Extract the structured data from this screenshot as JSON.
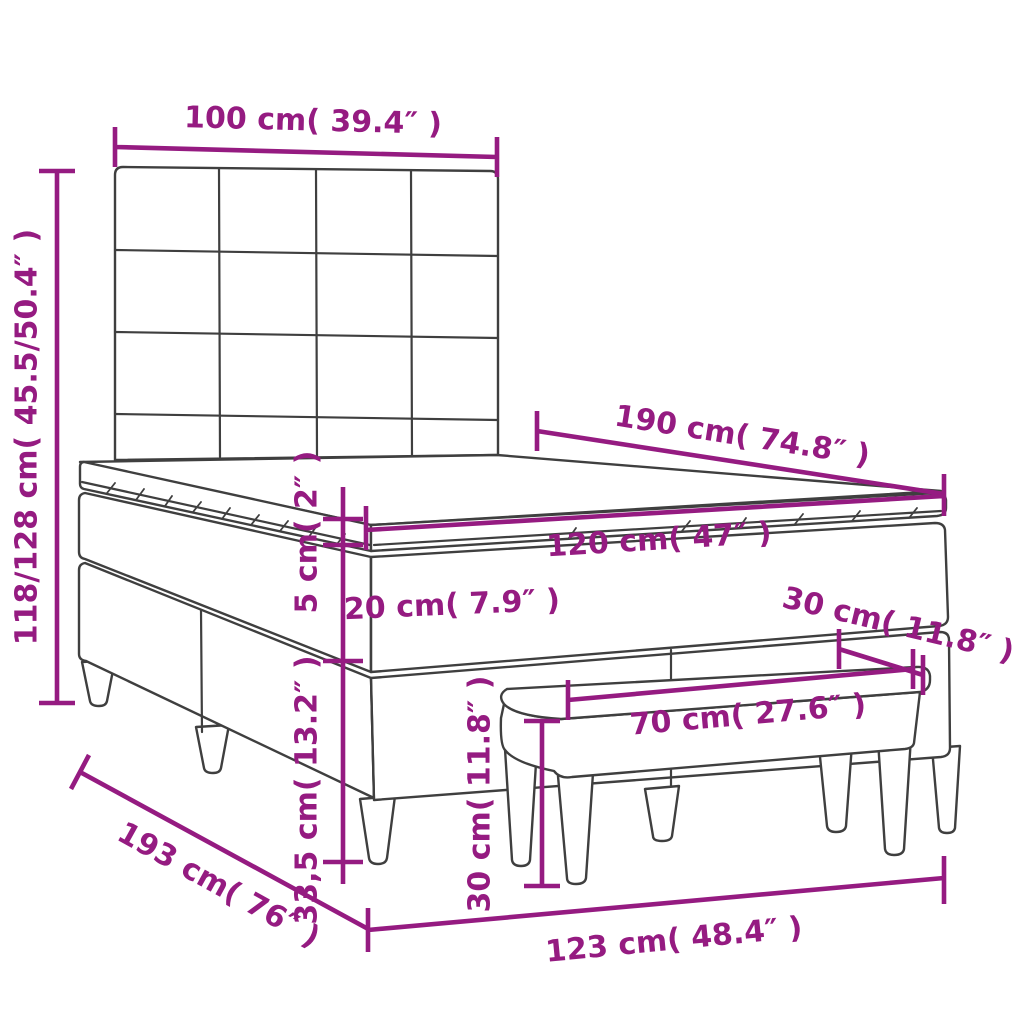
{
  "diagram": {
    "title": "bed with headboard and bench dimension diagram",
    "style": {
      "accent_color": "#951b81",
      "line_art_color": "#3f3f3f",
      "background_color": "#ffffff"
    },
    "parts": {
      "headboard": "tufted headboard (4x4 grid)",
      "topper": "mattress topper",
      "mattress": "mattress",
      "base": "box spring base",
      "bench": "bench with tapered legs"
    },
    "dimensions": [
      {
        "id": "headboard-width",
        "label": "100 cm( 39.4″ )",
        "measures": "headboard width"
      },
      {
        "id": "total-height",
        "label": "118/128 cm( 45.5/50.4″ )",
        "measures": "headboard height range"
      },
      {
        "id": "bed-length",
        "label": "190 cm( 74.8″ )",
        "measures": "bed length"
      },
      {
        "id": "mattress-width",
        "label": "120 cm( 47″ )",
        "measures": "mattress width"
      },
      {
        "id": "topper-thickness",
        "label": "5 cm( 2″ )",
        "measures": "topper thickness"
      },
      {
        "id": "mattress-thickness",
        "label": "20 cm( 7.9″ )",
        "measures": "mattress thickness"
      },
      {
        "id": "bench-depth",
        "label": "30 cm( 11.8″ )",
        "measures": "bench depth"
      },
      {
        "id": "base-height",
        "label": "33,5 cm( 13.2″ )",
        "measures": "box spring base height"
      },
      {
        "id": "bench-length",
        "label": "70 cm( 27.6″ )",
        "measures": "bench length"
      },
      {
        "id": "bench-height",
        "label": "30 cm( 11.8″ )",
        "measures": "bench height"
      },
      {
        "id": "total-length",
        "label": "193 cm( 76″ )",
        "measures": "total length"
      },
      {
        "id": "total-width",
        "label": "123 cm( 48.4″ )",
        "measures": "total width"
      }
    ]
  }
}
